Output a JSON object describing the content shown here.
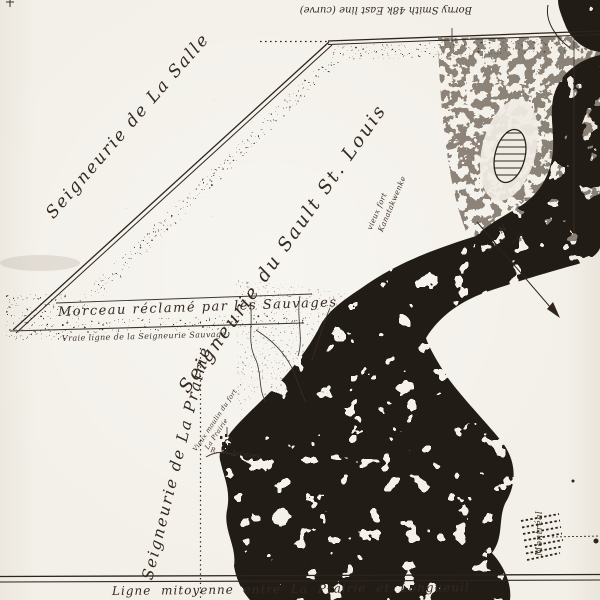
{
  "map": {
    "colors": {
      "paper": "#f2efe8",
      "ink": "#2e241c",
      "water": "#241b14"
    },
    "labels": {
      "top_note": "Borny Smith 48k East line (curve)",
      "seigneurie_la_salle": "Seigneurie de La Salle",
      "seigneurie_sault_st_louis": "Seigneurie du Sault St. Louis",
      "morceau_reclame": "Morceau réclamé par les Sauvages",
      "vraie_ligne": "Vraie ligne de la Seigneurie Sauvage",
      "seigneurie_la_prairie": "Seigneurie de La Prairie",
      "ligne_mitoyenne": "Ligne mitoyenne entre La Prairie et Longueuil",
      "montreal": "Montréal",
      "river_note_1": "Kanatakwenke",
      "river_note_2": "vieux fort",
      "moulin_note": "Vieux moulin du fort",
      "la_prairie_village": "La Prairie",
      "riv_st_jacques": "R. St. Jacques",
      "north_letter": "N"
    }
  }
}
